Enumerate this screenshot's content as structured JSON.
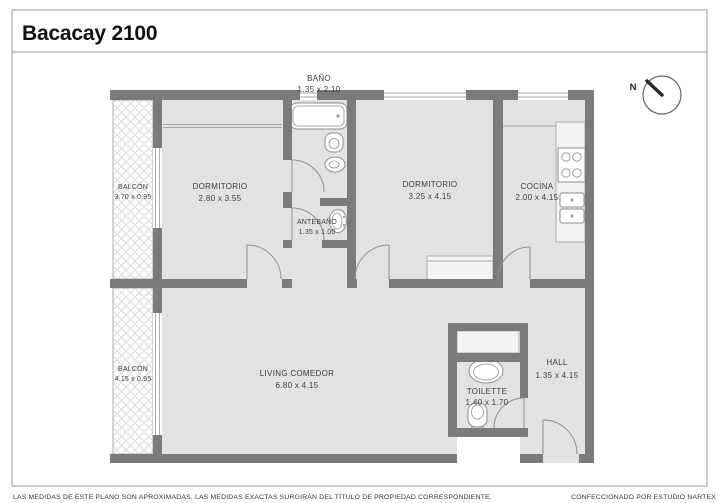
{
  "header": {
    "title": "Bacacay 2100"
  },
  "compass": {
    "north_label": "N"
  },
  "rooms": {
    "bano": {
      "name": "BAÑO",
      "dims": "1.35 x 2.10"
    },
    "balcon_top": {
      "name": "BALCÓN",
      "dims": "3.70 x 0.95"
    },
    "dormitorio_1": {
      "name": "DORMITORIO",
      "dims": "2.80 x 3.55"
    },
    "antebano": {
      "name": "ANTEBAÑO",
      "dims": "1.35 x 1.00"
    },
    "dormitorio_2": {
      "name": "DORMITORIO",
      "dims": "3.25 x 4.15"
    },
    "cocina": {
      "name": "COCINA",
      "dims": "2.00 x 4.15"
    },
    "living": {
      "name": "LIVING COMEDOR",
      "dims": "6.80 x 4.15"
    },
    "balcon_bottom": {
      "name": "BALCÓN",
      "dims": "4.15 x 0.95"
    },
    "toilette": {
      "name": "TOILETTE",
      "dims": "1.40 x 1.70"
    },
    "hall": {
      "name": "HALL",
      "dims": "1.35 x 4.15"
    }
  },
  "footer": {
    "disclaimer": "LAS MEDIDAS  DE ESTE PLANO SON APROXIMADAS. LAS MEDIDAS EXACTAS SURGIRÁN DEL TÍTULO DE PROPIEDAD CORRESPONDIENTE.",
    "credit": "CONFECCIONADO POR ESTUDIO NARTEX"
  },
  "colors": {
    "wall": "#7b7b7b",
    "floor": "#e2e2e2",
    "line": "#8f8f8f",
    "thin": "#a6a6a6",
    "hatch": "#dcdcdc",
    "text": "#3d3d3d",
    "title": "#111111",
    "frame": "#999999"
  }
}
